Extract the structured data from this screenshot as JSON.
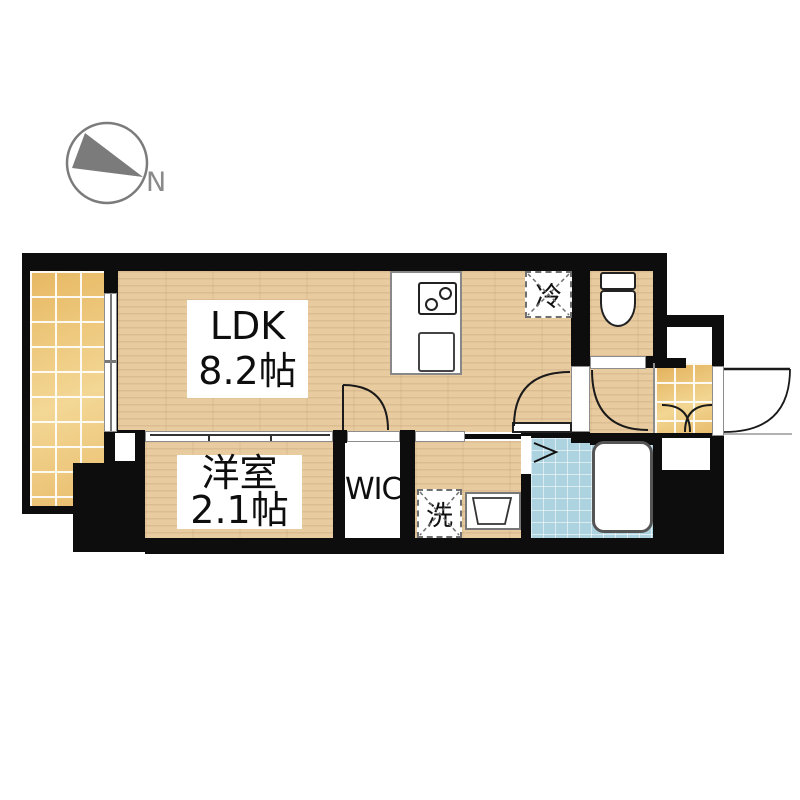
{
  "compass": {
    "north_label": "N"
  },
  "rooms": [
    {
      "id": "ldk",
      "name": "LDK",
      "size_label": "8.2帖"
    },
    {
      "id": "bedroom",
      "name": "洋室",
      "size_label": "2.1帖"
    },
    {
      "id": "wic",
      "name": "WIC"
    }
  ],
  "fixtures": [
    {
      "id": "refrigerator",
      "label": "冷"
    },
    {
      "id": "washer",
      "label": "洗"
    }
  ],
  "colors": {
    "wall": "#0d0d0d",
    "wood": "#e9cba0",
    "tile_gold": "#ecc57d",
    "tile_bath": "#aed3e0",
    "compass": "#7b7b7b"
  }
}
